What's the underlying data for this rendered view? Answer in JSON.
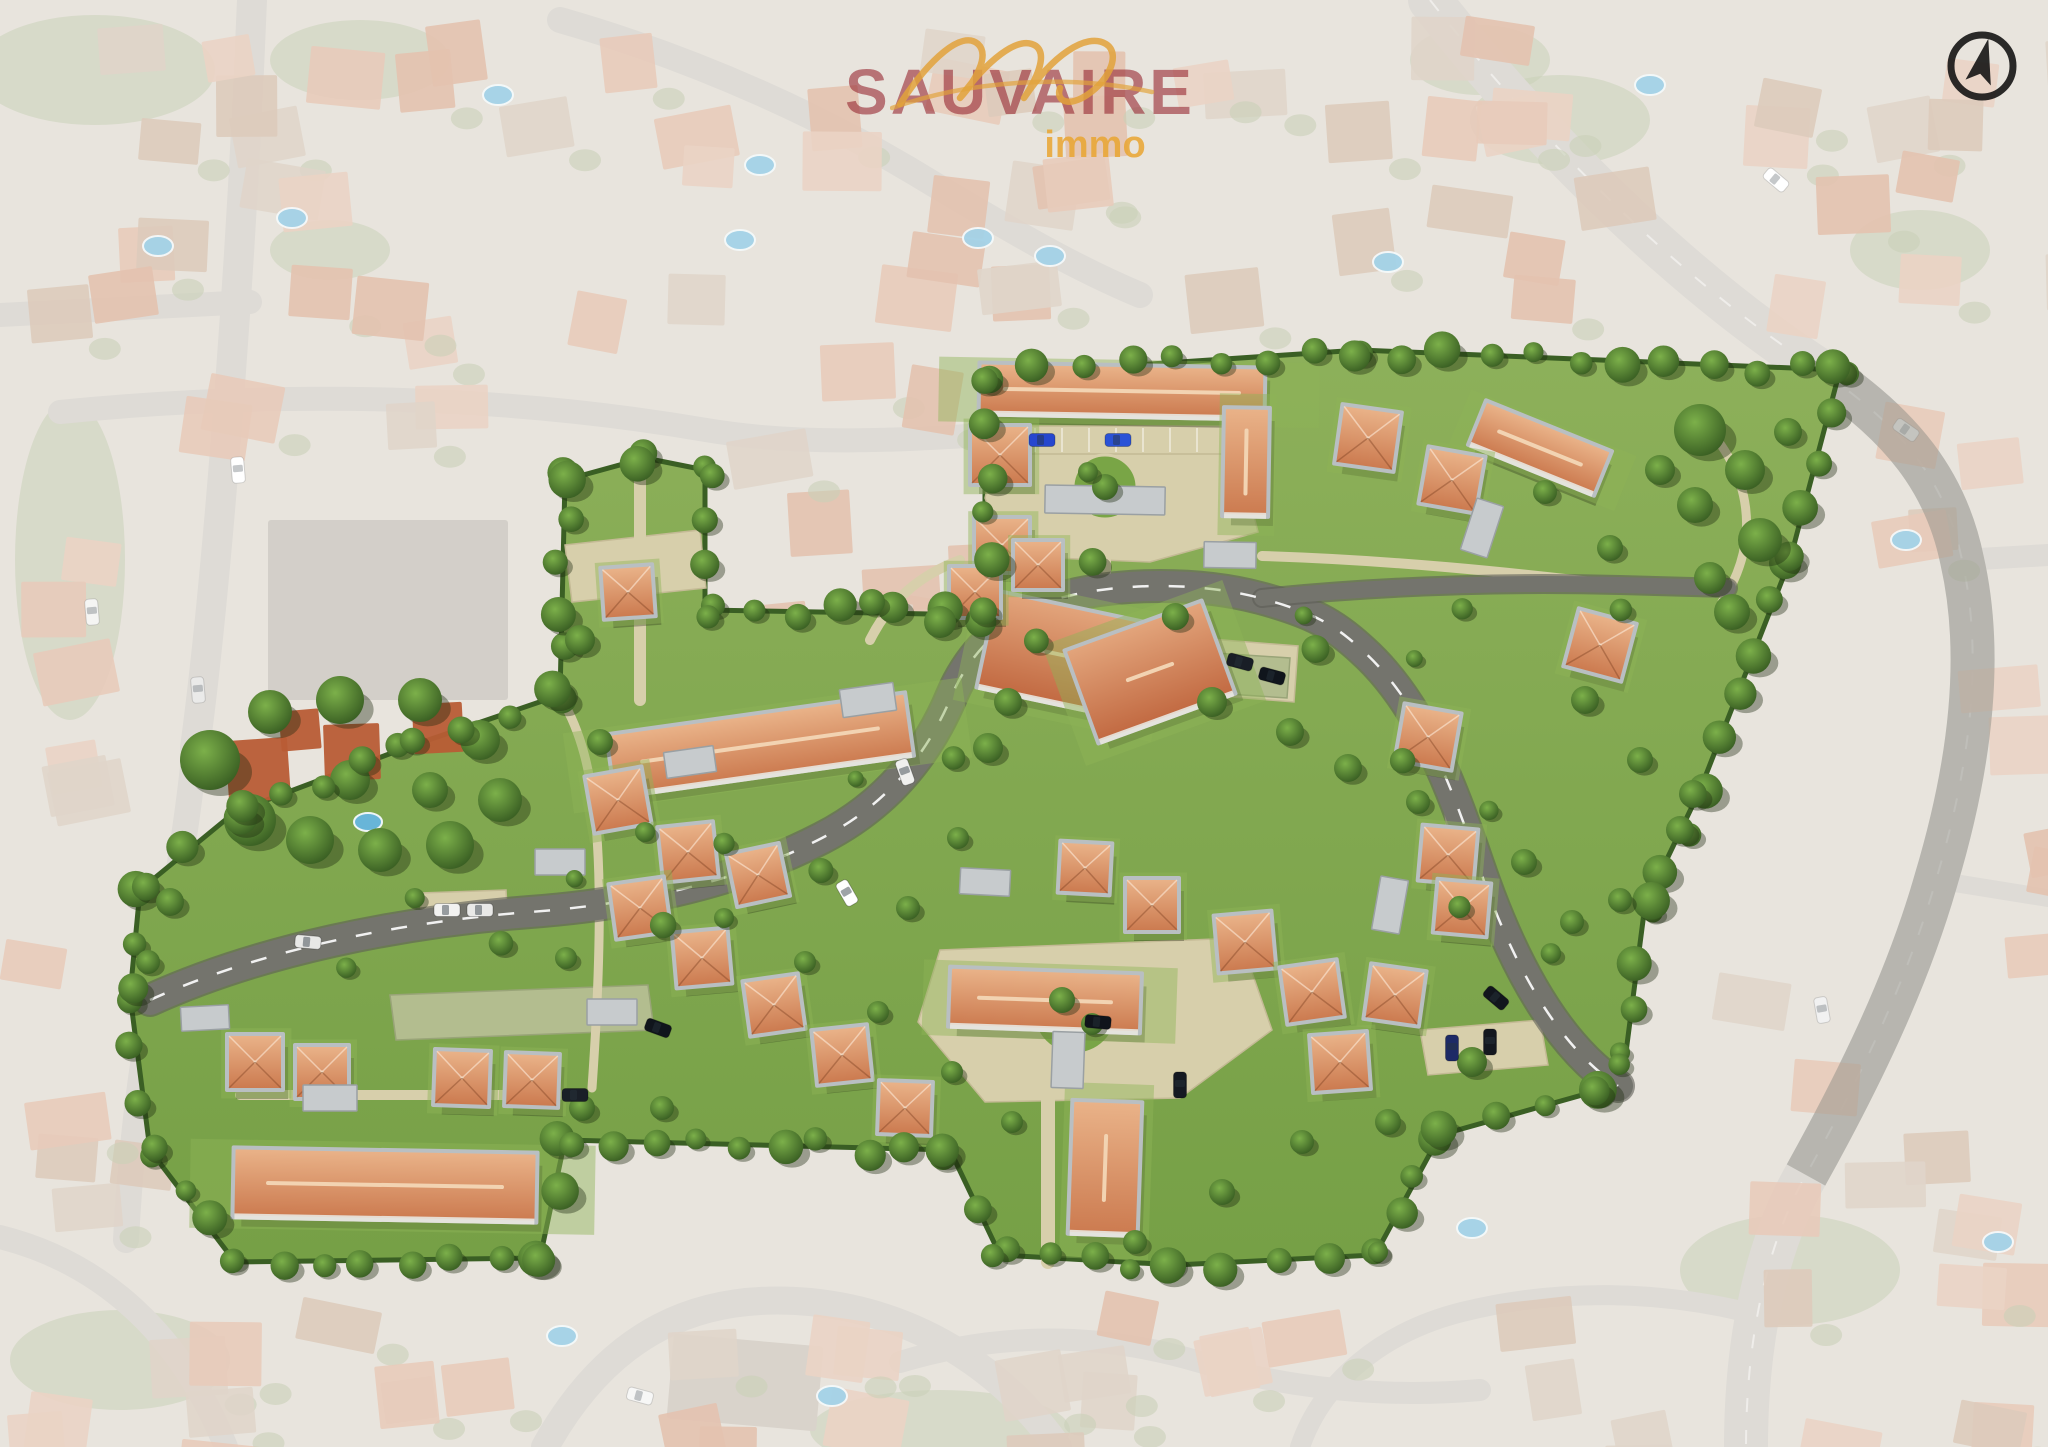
{
  "brand": {
    "script": "mc",
    "name": "SAUVAIRE",
    "tagline": "immo",
    "name_color": "#962630",
    "gold_color": "#e9a430"
  },
  "compass": {
    "meaning": "north-arrow"
  },
  "palette": {
    "bg_base": "#d9d3c7",
    "bg_road": "#c8c3bb",
    "bg_green": "#a6b289",
    "pool": "#68b5d8",
    "veil": "rgba(255,255,255,0.40)",
    "lawn1": "#8db05a",
    "lawn2": "#76a046",
    "hedge": "#3a5f24",
    "dev_road": "#74746d",
    "dev_path": "#d7cfab",
    "lattice": "#b3bd8f",
    "roof_hi": "#e9b288",
    "roof_lo": "#cc7b50",
    "wing_hi": "#e2a47b",
    "wing_lo": "#c26a42",
    "ridge": "#f2d3b2",
    "walls": "#b9bfc2",
    "tree_hi": "#7cb04a",
    "tree_lo": "#33571f"
  },
  "bg": {
    "roads": [
      [
        "M 252,0 C 240,300 215,600 195,748",
        30
      ],
      [
        "M 195,748 C 185,850 165,950 150,1020 C 138,1090 130,1160 126,1240",
        26
      ],
      [
        "M 0,315 L 250,302",
        24
      ],
      [
        "M 60,412 C 300,388 520,398 706,430 C 800,446 900,440 985,435",
        24
      ],
      [
        "M 560,20 C 700,60 830,120 935,185 C 1010,230 1075,268 1140,295",
        26
      ],
      [
        "M 1430,0 C 1540,140 1680,280 1822,372 C 1902,426 1946,482 1962,560 C 1986,665 1966,780 1936,880 C 1906,985 1856,1085 1806,1175 C 1766,1245 1746,1340 1746,1447",
        44
      ],
      [
        "M 1962,560 L 2048,555",
        22
      ],
      [
        "M 1936,880 L 2048,898",
        18
      ],
      [
        "M 545,1447 C 610,1330 700,1292 810,1302 C 930,1314 1010,1380 1058,1447",
        28
      ],
      [
        "M 0,1237 C 100,1262 180,1332 226,1447",
        24
      ],
      [
        "M 1300,1447 C 1322,1382 1382,1332 1462,1312 C 1562,1287 1662,1292 1746,1312",
        20
      ],
      [
        "M 900,1362 C 1000,1332 1100,1332 1200,1362 C 1290,1390 1390,1398 1480,1390",
        22
      ]
    ],
    "regions": [
      [
        10,
        10,
        540,
        400,
        22,
        11
      ],
      [
        560,
        10,
        400,
        370,
        14,
        22
      ],
      [
        960,
        20,
        420,
        280,
        13,
        33
      ],
      [
        1390,
        10,
        400,
        300,
        13,
        44
      ],
      [
        1810,
        10,
        238,
        340,
        8,
        55
      ],
      [
        1860,
        360,
        188,
        560,
        8,
        66
      ],
      [
        1700,
        930,
        348,
        500,
        14,
        77
      ],
      [
        1010,
        1290,
        720,
        157,
        10,
        88
      ],
      [
        540,
        1290,
        470,
        157,
        8,
        99
      ],
      [
        0,
        1280,
        540,
        167,
        10,
        111
      ],
      [
        0,
        1060,
        130,
        220,
        4,
        122
      ],
      [
        0,
        440,
        130,
        600,
        7,
        133
      ],
      [
        710,
        430,
        270,
        180,
        7,
        144
      ]
    ],
    "house_fills": [
      "#d8a98d",
      "#d19a7b",
      "#ddb79f",
      "#cbb9a6",
      "#c7a98f"
    ],
    "big_buildings": [
      [
        268,
        520,
        240,
        180,
        0,
        "#b6b0a5"
      ],
      [
        670,
        1340,
        150,
        85,
        5,
        "#c0b6a9"
      ]
    ],
    "greens": [
      [
        95,
        70,
        120,
        55
      ],
      [
        360,
        60,
        90,
        40
      ],
      [
        70,
        560,
        55,
        160
      ],
      [
        1560,
        120,
        90,
        45
      ],
      [
        1920,
        250,
        70,
        40
      ],
      [
        1790,
        1270,
        110,
        55
      ],
      [
        120,
        1360,
        110,
        50
      ],
      [
        940,
        1430,
        130,
        40
      ],
      [
        1480,
        60,
        70,
        35
      ],
      [
        330,
        250,
        60,
        30
      ]
    ],
    "pools": [
      [
        498,
        95
      ],
      [
        760,
        165
      ],
      [
        978,
        238
      ],
      [
        1050,
        256
      ],
      [
        1388,
        262
      ],
      [
        292,
        218
      ],
      [
        158,
        246
      ],
      [
        1650,
        85
      ],
      [
        1472,
        1228
      ],
      [
        562,
        1336
      ],
      [
        832,
        1396
      ],
      [
        1998,
        1242
      ],
      [
        1906,
        540
      ],
      [
        740,
        240
      ]
    ],
    "cars": [
      [
        238,
        470,
        85,
        "#ffffff"
      ],
      [
        198,
        690,
        85,
        "#dcdcda"
      ],
      [
        1906,
        430,
        35,
        "#f4f4f2"
      ],
      [
        1822,
        1010,
        80,
        "#e8e8e8"
      ],
      [
        640,
        1396,
        15,
        "#f2f2f0"
      ],
      [
        568,
        560,
        0,
        "#d24635"
      ],
      [
        92,
        612,
        85,
        "#eeeeec"
      ],
      [
        1776,
        180,
        40,
        "#ffffff"
      ]
    ],
    "vivid_road": [
      "M 1822,372 C 1902,426 1946,482 1962,560 C 1986,665 1966,780 1936,880 C 1906,985 1856,1085 1806,1175",
      44
    ]
  },
  "dev": {
    "outline": [
      [
        985,
        615
      ],
      [
        985,
        375
      ],
      [
        1360,
        350
      ],
      [
        1840,
        370
      ],
      [
        1790,
        560
      ],
      [
        1700,
        790
      ],
      [
        1645,
        905
      ],
      [
        1625,
        1060
      ],
      [
        1600,
        1090
      ],
      [
        1440,
        1135
      ],
      [
        1375,
        1255
      ],
      [
        1175,
        1265
      ],
      [
        1000,
        1255
      ],
      [
        950,
        1150
      ],
      [
        565,
        1140
      ],
      [
        540,
        1258
      ],
      [
        235,
        1262
      ],
      [
        150,
        1150
      ],
      [
        130,
        995
      ],
      [
        140,
        890
      ],
      [
        235,
        812
      ],
      [
        405,
        748
      ],
      [
        560,
        695
      ],
      [
        565,
        480
      ],
      [
        645,
        458
      ],
      [
        705,
        470
      ],
      [
        705,
        610
      ]
    ],
    "roads": [
      [
        "M 150,1000 C 260,950 400,922 530,912 C 650,903 745,878 822,838 C 892,802 930,748 952,695 C 972,648 1010,615 1060,598 C 1120,582 1200,582 1260,598 C 1312,612 1334,624 1362,650 C 1420,702 1450,782 1478,864 C 1508,952 1552,1042 1618,1086",
        30
      ],
      [
        "M 1262,598 C 1380,586 1500,582 1620,585 L 1728,588",
        16
      ]
    ],
    "dash_road": 0,
    "paths": [
      [
        "M 640,468 L 640,700",
        12
      ],
      [
        "M 1105,560 L 1105,598",
        12
      ],
      [
        "M 1262,556 C 1390,560 1510,572 1625,586",
        10
      ],
      [
        "M 1048,1088 L 1048,1262",
        14
      ],
      [
        "M 240,1095 L 560,1095",
        10
      ],
      [
        "M 562,700 C 598,760 608,860 592,1088",
        9
      ],
      [
        "M 1430,740 C 1452,800 1456,862 1450,922",
        8
      ],
      [
        "M 1700,420 C 1752,472 1762,540 1722,602",
        9
      ],
      [
        "M 870,640 C 890,600 920,575 960,560",
        10
      ]
    ],
    "plazas": [
      [
        [
          1000,
          430
        ],
        [
          1232,
          430
        ],
        [
          1258,
          532
        ],
        [
          1150,
          562
        ],
        [
          1008,
          556
        ],
        [
          985,
          498
        ]
      ],
      [
        [
          940,
          950
        ],
        [
          1240,
          938
        ],
        [
          1272,
          1030
        ],
        [
          1180,
          1098
        ],
        [
          985,
          1102
        ],
        [
          918,
          1022
        ]
      ],
      [
        [
          565,
          545
        ],
        [
          700,
          530
        ],
        [
          706,
          588
        ],
        [
          572,
          602
        ]
      ],
      [
        [
          1198,
          638
        ],
        [
          1298,
          646
        ],
        [
          1294,
          702
        ],
        [
          1196,
          694
        ]
      ],
      [
        [
          420,
          893
        ],
        [
          506,
          890
        ],
        [
          508,
          926
        ],
        [
          422,
          929
        ]
      ],
      [
        [
          1000,
          426
        ],
        [
          1232,
          426
        ],
        [
          1232,
          454
        ],
        [
          1000,
          454
        ]
      ],
      [
        [
          1420,
          1030
        ],
        [
          1540,
          1020
        ],
        [
          1548,
          1065
        ],
        [
          1428,
          1075
        ]
      ]
    ],
    "lattices": [
      [
        [
          390,
          995
        ],
        [
          648,
          985
        ],
        [
          654,
          1030
        ],
        [
          396,
          1040
        ]
      ],
      [
        [
          1200,
          652
        ],
        [
          1290,
          658
        ],
        [
          1287,
          698
        ],
        [
          1198,
          692
        ]
      ]
    ],
    "islands": [
      [
        1105,
        487,
        32
      ],
      [
        1075,
        1012,
        42
      ]
    ],
    "buildings": [
      [
        "bar",
        1122,
        391,
        282,
        48,
        1
      ],
      [
        "bar",
        1246,
        462,
        42,
        105,
        1
      ],
      [
        "bar",
        760,
        745,
        298,
        60,
        -8
      ],
      [
        "bar",
        385,
        1185,
        300,
        66,
        1
      ],
      [
        "bar",
        1105,
        1168,
        66,
        130,
        2
      ],
      [
        "bar",
        1045,
        1000,
        188,
        56,
        2
      ],
      [
        "bar",
        1540,
        448,
        132,
        44,
        22
      ],
      [
        "wing",
        1062,
        655,
        150,
        95,
        12
      ],
      [
        "wing",
        1150,
        672,
        142,
        95,
        -20
      ],
      [
        "h",
        1000,
        455,
        56,
        56,
        0
      ],
      [
        "h",
        1002,
        545,
        52,
        52,
        0
      ],
      [
        "h",
        1368,
        438,
        56,
        56,
        8
      ],
      [
        "h",
        1452,
        480,
        54,
        54,
        10
      ],
      [
        "h",
        1600,
        645,
        56,
        56,
        15
      ],
      [
        "h",
        1428,
        737,
        54,
        54,
        10
      ],
      [
        "h",
        1448,
        855,
        52,
        52,
        5
      ],
      [
        "h",
        1462,
        908,
        50,
        50,
        5
      ],
      [
        "h",
        1395,
        995,
        52,
        52,
        8
      ],
      [
        "h",
        1245,
        942,
        54,
        54,
        -5
      ],
      [
        "h",
        1312,
        992,
        54,
        54,
        -8
      ],
      [
        "h",
        1340,
        1062,
        54,
        54,
        -4
      ],
      [
        "h",
        1152,
        905,
        50,
        50,
        0
      ],
      [
        "h",
        1085,
        868,
        48,
        48,
        3
      ],
      [
        "h",
        618,
        800,
        54,
        54,
        -10
      ],
      [
        "h",
        688,
        852,
        52,
        52,
        -6
      ],
      [
        "h",
        758,
        875,
        50,
        50,
        -12
      ],
      [
        "h",
        640,
        908,
        52,
        52,
        -8
      ],
      [
        "h",
        702,
        958,
        52,
        52,
        -5
      ],
      [
        "h",
        774,
        1005,
        52,
        52,
        -8
      ],
      [
        "h",
        842,
        1055,
        52,
        52,
        -6
      ],
      [
        "h",
        628,
        592,
        48,
        48,
        -4
      ],
      [
        "h",
        905,
        1108,
        50,
        50,
        2
      ],
      [
        "h",
        255,
        1062,
        52,
        52,
        0
      ],
      [
        "h",
        322,
        1072,
        50,
        50,
        0
      ],
      [
        "h",
        462,
        1078,
        52,
        52,
        2
      ],
      [
        "h",
        532,
        1080,
        50,
        50,
        2
      ],
      [
        "h",
        975,
        592,
        48,
        48,
        0
      ],
      [
        "h",
        1038,
        565,
        46,
        46,
        0
      ]
    ],
    "panels": [
      [
        1105,
        500,
        120,
        28,
        1
      ],
      [
        868,
        700,
        54,
        28,
        -8
      ],
      [
        612,
        1012,
        50,
        26,
        0
      ],
      [
        985,
        882,
        50,
        26,
        3
      ],
      [
        1390,
        905,
        28,
        54,
        10
      ],
      [
        1482,
        528,
        28,
        54,
        18
      ],
      [
        330,
        1098,
        54,
        26,
        0
      ],
      [
        690,
        762,
        50,
        26,
        -8
      ],
      [
        1068,
        1060,
        32,
        56,
        2
      ],
      [
        205,
        1018,
        48,
        24,
        -3
      ],
      [
        560,
        862,
        50,
        26,
        0
      ],
      [
        1230,
        555,
        52,
        26,
        1
      ]
    ],
    "preserve": {
      "trees": [
        [
          210,
          760,
          30
        ],
        [
          250,
          820,
          26
        ],
        [
          310,
          840,
          24
        ],
        [
          380,
          850,
          22
        ],
        [
          450,
          845,
          24
        ],
        [
          500,
          800,
          22
        ],
        [
          480,
          740,
          20
        ],
        [
          420,
          700,
          22
        ],
        [
          340,
          700,
          24
        ],
        [
          270,
          712,
          22
        ],
        [
          350,
          780,
          20
        ],
        [
          430,
          790,
          18
        ]
      ],
      "houses": [
        [
          258,
          770,
          62,
          -4
        ],
        [
          352,
          752,
          56,
          -2
        ],
        [
          438,
          728,
          50,
          -3
        ],
        [
          300,
          730,
          40,
          -5
        ]
      ],
      "pool": [
        368,
        822
      ]
    },
    "trees": [
      [
        1700,
        430,
        26
      ],
      [
        1745,
        470,
        20
      ],
      [
        1695,
        505,
        18
      ],
      [
        1760,
        540,
        22
      ],
      [
        1710,
        578,
        16
      ],
      [
        1660,
        470,
        15
      ],
      [
        1788,
        432,
        14
      ],
      [
        1732,
        612,
        18
      ],
      [
        940,
        622,
        16
      ],
      [
        1008,
        702,
        14
      ],
      [
        872,
        602,
        13
      ],
      [
        1212,
        702,
        15
      ],
      [
        1290,
        732,
        14
      ],
      [
        988,
        748,
        15
      ],
      [
        580,
        640,
        15
      ],
      [
        600,
        742,
        13
      ],
      [
        170,
        902,
        14
      ],
      [
        148,
        962,
        12
      ],
      [
        582,
        1108,
        13
      ],
      [
        662,
        1108,
        12
      ],
      [
        908,
        908,
        12
      ],
      [
        958,
        838,
        11
      ],
      [
        1348,
        768,
        14
      ],
      [
        1418,
        802,
        12
      ],
      [
        1524,
        862,
        13
      ],
      [
        1572,
        922,
        12
      ],
      [
        1472,
        1062,
        15
      ],
      [
        1388,
        1122,
        13
      ],
      [
        1302,
        1142,
        12
      ],
      [
        1222,
        1192,
        13
      ],
      [
        1135,
        1242,
        12
      ],
      [
        566,
        958,
        11
      ],
      [
        645,
        832,
        10
      ],
      [
        724,
        918,
        10
      ],
      [
        805,
        962,
        11
      ],
      [
        878,
        1012,
        11
      ],
      [
        952,
        1072,
        11
      ],
      [
        1012,
        1122,
        11
      ],
      [
        1105,
        487,
        13
      ],
      [
        1088,
        472,
        10
      ],
      [
        1062,
        1000,
        13
      ],
      [
        1092,
        1024,
        11
      ],
      [
        1585,
        700,
        14
      ],
      [
        1640,
        760,
        13
      ],
      [
        1680,
        830,
        14
      ],
      [
        1620,
        900,
        12
      ],
      [
        1545,
        492,
        12
      ],
      [
        1610,
        548,
        13
      ]
    ],
    "cars": [
      [
        1042,
        440,
        0,
        "#2647cf"
      ],
      [
        1118,
        440,
        0,
        "#2a52d6"
      ],
      [
        447,
        910,
        0,
        "#f2f2f0"
      ],
      [
        480,
        910,
        0,
        "#e9e9e7"
      ],
      [
        1240,
        662,
        15,
        "#191e26"
      ],
      [
        1272,
        676,
        15,
        "#10151c"
      ],
      [
        658,
        1028,
        20,
        "#10151c"
      ],
      [
        905,
        772,
        70,
        "#f0f0ee"
      ],
      [
        1098,
        1022,
        5,
        "#10141b"
      ],
      [
        1496,
        998,
        40,
        "#12161d"
      ],
      [
        308,
        942,
        5,
        "#e8e8e6"
      ],
      [
        847,
        893,
        60,
        "#ffffff"
      ],
      [
        1180,
        1085,
        90,
        "#151a22"
      ],
      [
        575,
        1095,
        0,
        "#1a1f27"
      ],
      [
        1452,
        1048,
        90,
        "#1d2a66"
      ],
      [
        1490,
        1042,
        90,
        "#14181f"
      ]
    ]
  }
}
